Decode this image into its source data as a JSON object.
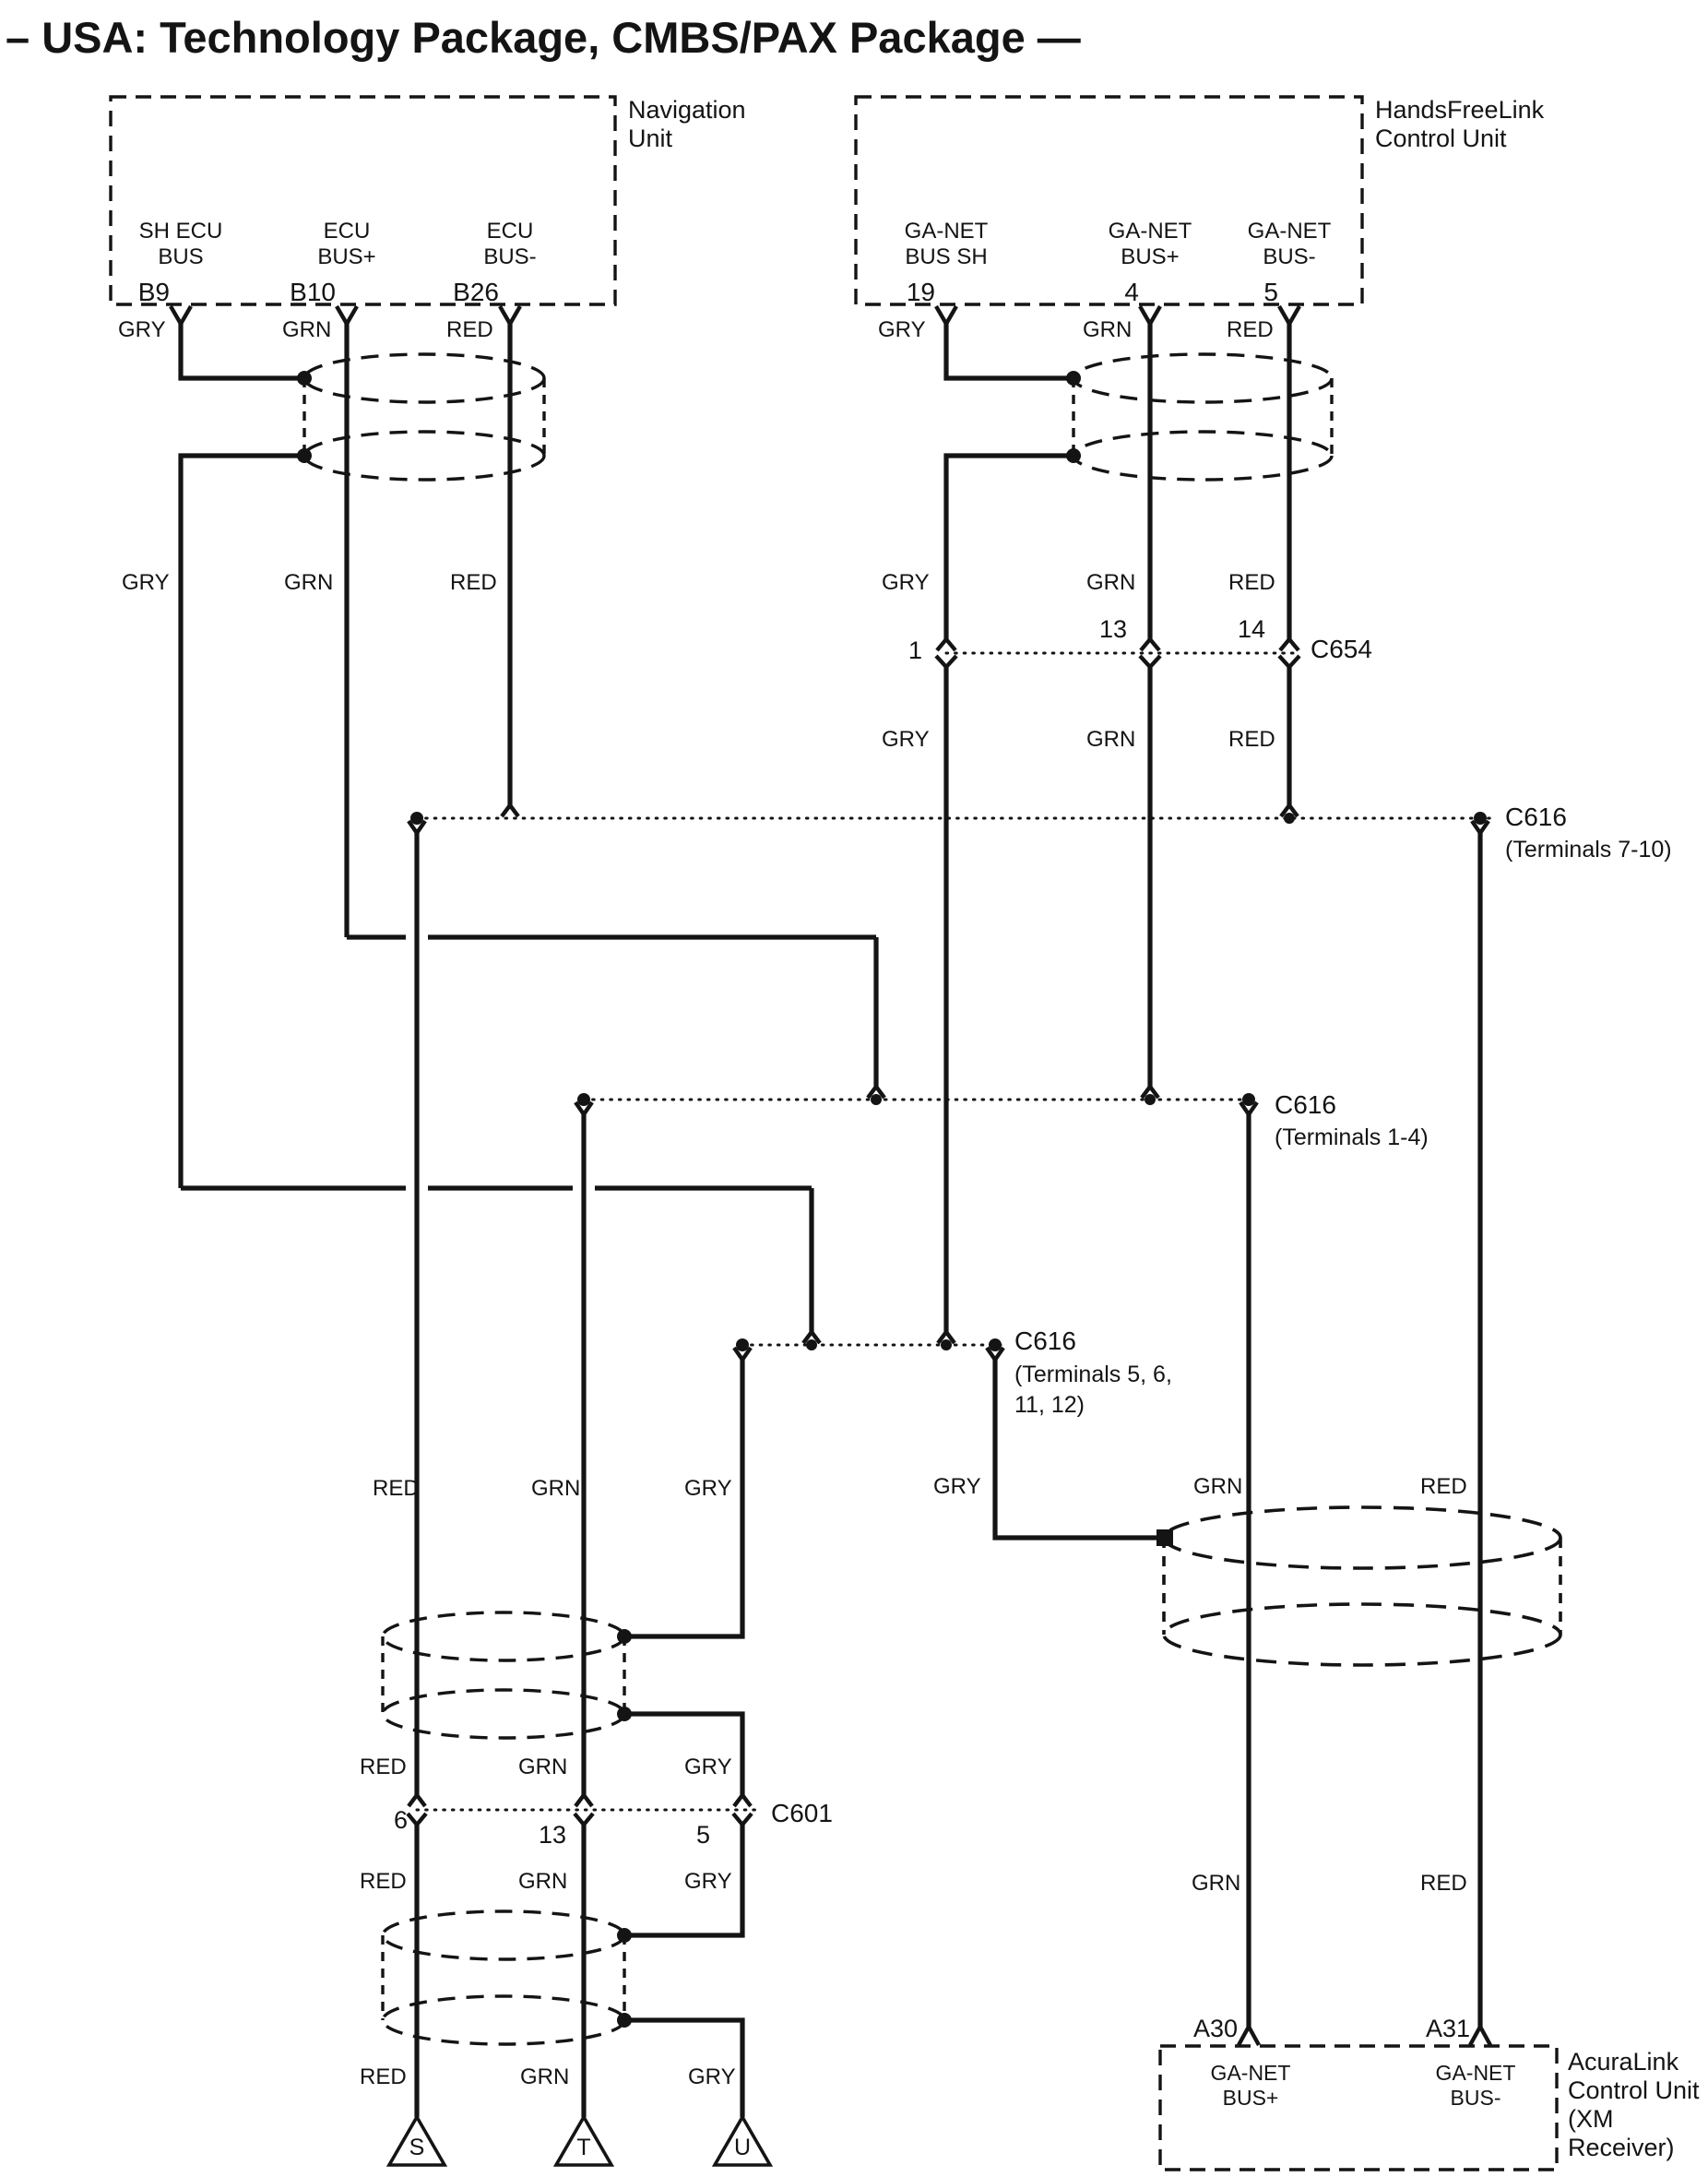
{
  "title": "– USA: Technology Package, CMBS/PAX Package —",
  "units": {
    "navigation": {
      "name": "Navigation\nUnit",
      "pins": [
        {
          "bus": "SH ECU\nBUS",
          "pin": "B9",
          "color": "GRY"
        },
        {
          "bus": "ECU\nBUS+",
          "pin": "B10",
          "color": "GRN"
        },
        {
          "bus": "ECU\nBUS-",
          "pin": "B26",
          "color": "RED"
        }
      ]
    },
    "handsfreelink": {
      "name": "HandsFreeLink\nControl Unit",
      "pins": [
        {
          "bus": "GA-NET\nBUS SH",
          "pin": "19",
          "color": "GRY"
        },
        {
          "bus": "GA-NET\nBUS+",
          "pin": "4",
          "color": "GRN"
        },
        {
          "bus": "GA-NET\nBUS-",
          "pin": "5",
          "color": "RED"
        }
      ]
    },
    "acuralink": {
      "name": "AcuraLink\nControl Unit\n(XM\nReceiver)",
      "pins": [
        {
          "bus": "GA-NET\nBUS+",
          "pin": "A30"
        },
        {
          "bus": "GA-NET\nBUS-",
          "pin": "A31"
        }
      ]
    }
  },
  "connectors": {
    "c654": {
      "name": "C654",
      "pins": [
        "1",
        "13",
        "14"
      ]
    },
    "c601": {
      "name": "C601",
      "pins": [
        "6",
        "13",
        "5"
      ]
    },
    "c616_7_10": {
      "name": "C616",
      "note": "(Terminals 7-10)"
    },
    "c616_1_4": {
      "name": "C616",
      "note": "(Terminals 1-4)"
    },
    "c616_5_6_11_12": {
      "name": "C616",
      "note": "(Terminals 5, 6,\n11, 12)"
    }
  },
  "wire_colors": {
    "gry": "GRY",
    "grn": "GRN",
    "red": "RED"
  },
  "grounds": [
    "S",
    "T",
    "U"
  ],
  "palette": {
    "ink": "#141414",
    "paper": "#ffffff"
  }
}
